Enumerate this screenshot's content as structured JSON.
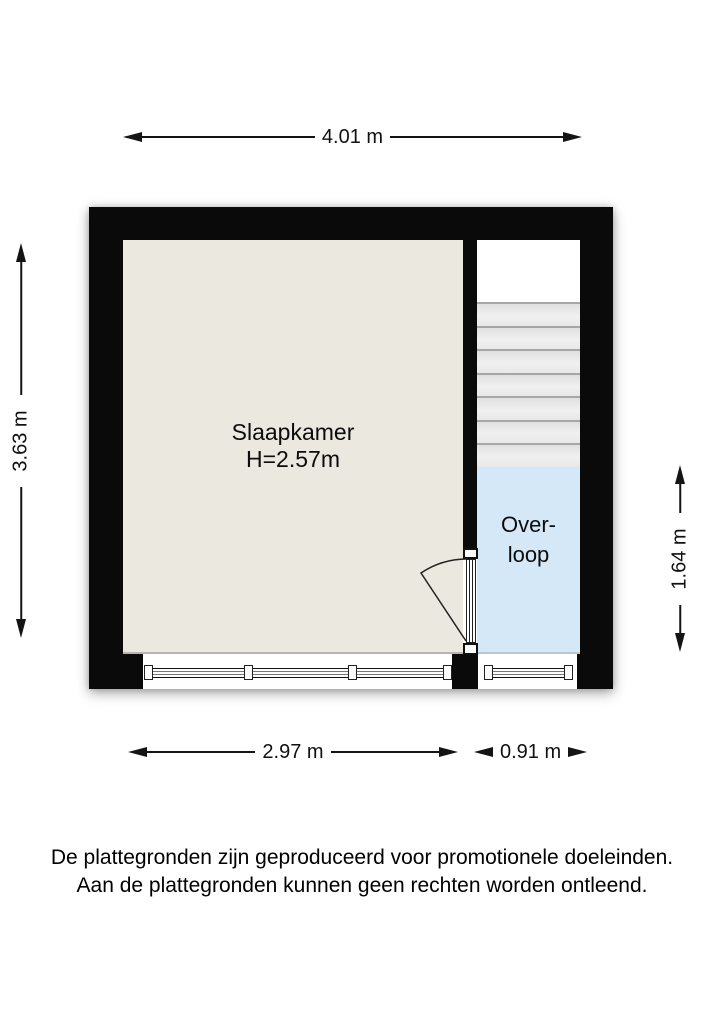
{
  "floorplan": {
    "rooms": {
      "slaapkamer": {
        "label": "Slaapkamer",
        "height_label": "H=2.57m"
      },
      "overloop": {
        "label_line1": "Over-",
        "label_line2": "loop"
      }
    },
    "stairs": {
      "step_count": 7
    },
    "dimensions": {
      "top": "4.01 m",
      "left": "3.63 m",
      "right": "1.64 m",
      "bottom_room": "2.97 m",
      "bottom_landing": "0.91 m"
    },
    "disclaimer": {
      "line1": "De plattegronden zijn geproduceerd voor promotionele doeleinden.",
      "line2": "Aan de plattegronden kunnen geen rechten worden ontleend."
    },
    "colors": {
      "wall": "#0a0a0a",
      "room_floor": "#eae8df",
      "landing_floor": "#d5e8f8",
      "step_fill": "#ebebeb",
      "dimension": "#141414"
    }
  }
}
